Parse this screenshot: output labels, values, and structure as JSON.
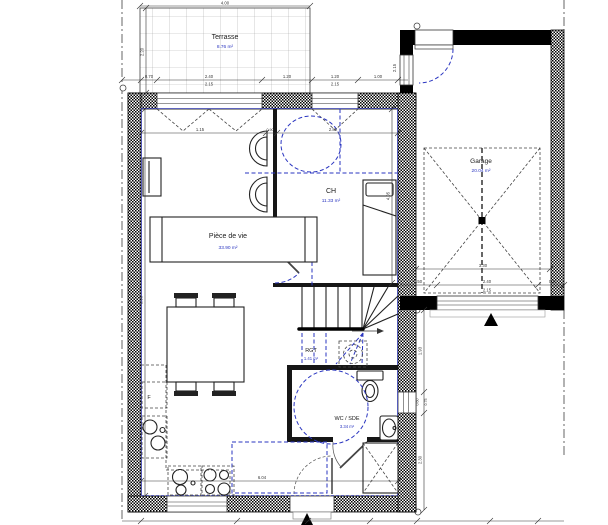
{
  "rooms": {
    "terrasse": {
      "name": "Terrasse",
      "area": "8.76 m²"
    },
    "piece_de_vie": {
      "name": "Pièce de vie",
      "area": "33.90 m²"
    },
    "ch": {
      "name": "CH",
      "area": "11.33 m²"
    },
    "rgt": {
      "name": "RGT",
      "area": "1.41 m²"
    },
    "wc_sde": {
      "name": "WC / SDE",
      "area": "3.34 m²"
    },
    "garage": {
      "name": "Garage",
      "area": "20.04 m²"
    }
  },
  "symbols": {
    "fridge": "F"
  },
  "dims": {
    "terrace_w": "4.00",
    "terrace_d": "2.20",
    "front_a": "0.70",
    "front_w1": "2.40",
    "front_w1h": "2.15",
    "front_b": "1.20",
    "front_w2": "1.20",
    "front_w2h": "2.15",
    "front_c": "1.00",
    "depth_total": "8.96",
    "width_total": "6.04",
    "living_a": "1.15",
    "living_b": "0.90",
    "ch_w": "2.82",
    "ch_d": "4.05",
    "garage_w": "3.30",
    "garage_a": "0.50",
    "garage_door_w": "2.40",
    "garage_door_h": "2.15",
    "garage_b": "0.40",
    "garage_side": "2.15",
    "right_a": "1.93",
    "right_w": "0.60",
    "right_wf": "0.75",
    "right_b": "2.30"
  },
  "colors": {
    "wall": "#000000",
    "annotation": "#2a35c0",
    "dimension": "#333333",
    "hatch_wall": "#1a1a1a"
  }
}
